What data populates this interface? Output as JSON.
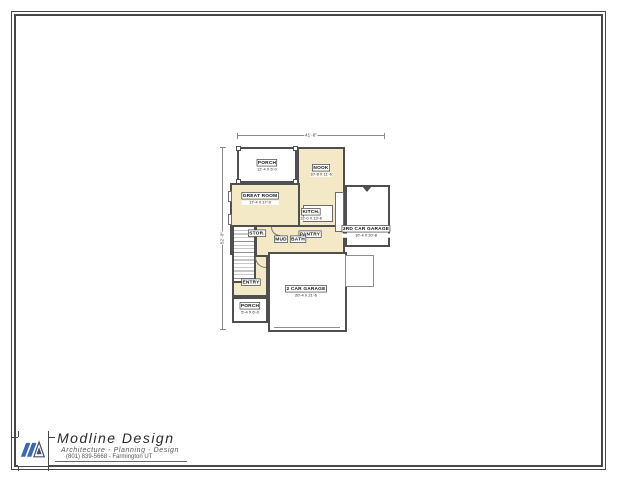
{
  "sheet": {
    "background": "#ffffff",
    "border_color": "#454a44"
  },
  "title_block": {
    "company": "Modline Design",
    "tagline": "Architecture - Planning - Design",
    "contact": "(801) 839-5668 - Farmington UT",
    "logo_icon": "modline-ma-logo",
    "logo_color": "#3a67ad"
  },
  "plan": {
    "dim_top": "41'-6\"",
    "dim_left": "52'-0\"",
    "wall_color": "#4f4f4d",
    "floor_fill": "#f3e9c7",
    "rooms": [
      {
        "name": "PORCH",
        "dims": "12'-4 X 6'-0",
        "x": 49,
        "y": 38
      },
      {
        "name": "NOOK",
        "dims": "10'-8 X 11'-6",
        "x": 103,
        "y": 43
      },
      {
        "name": "GREAT ROOM",
        "dims": "17'-4 X 17'-0",
        "x": 42,
        "y": 71
      },
      {
        "name": "KITCH.",
        "dims": "12'-0 X 13'-6",
        "x": 93,
        "y": 87
      },
      {
        "name": "PANTRY",
        "dims": "",
        "x": 92,
        "y": 107
      },
      {
        "name": "MUD",
        "dims": "",
        "x": 63,
        "y": 112
      },
      {
        "name": "BATH",
        "dims": "",
        "x": 80,
        "y": 112
      },
      {
        "name": "STOR.",
        "dims": "",
        "x": 39,
        "y": 106
      },
      {
        "name": "ENTRY",
        "dims": "",
        "x": 33,
        "y": 155
      },
      {
        "name": "PORCH",
        "dims": "5'-4 X 6'-0",
        "x": 32,
        "y": 181
      },
      {
        "name": "3RD CAR GARAGE",
        "dims": "10'-4 X 20'-8",
        "x": 148,
        "y": 104
      },
      {
        "name": "2 CAR GARAGE",
        "dims": "20'-4 X 21'-6",
        "x": 88,
        "y": 164
      }
    ]
  }
}
